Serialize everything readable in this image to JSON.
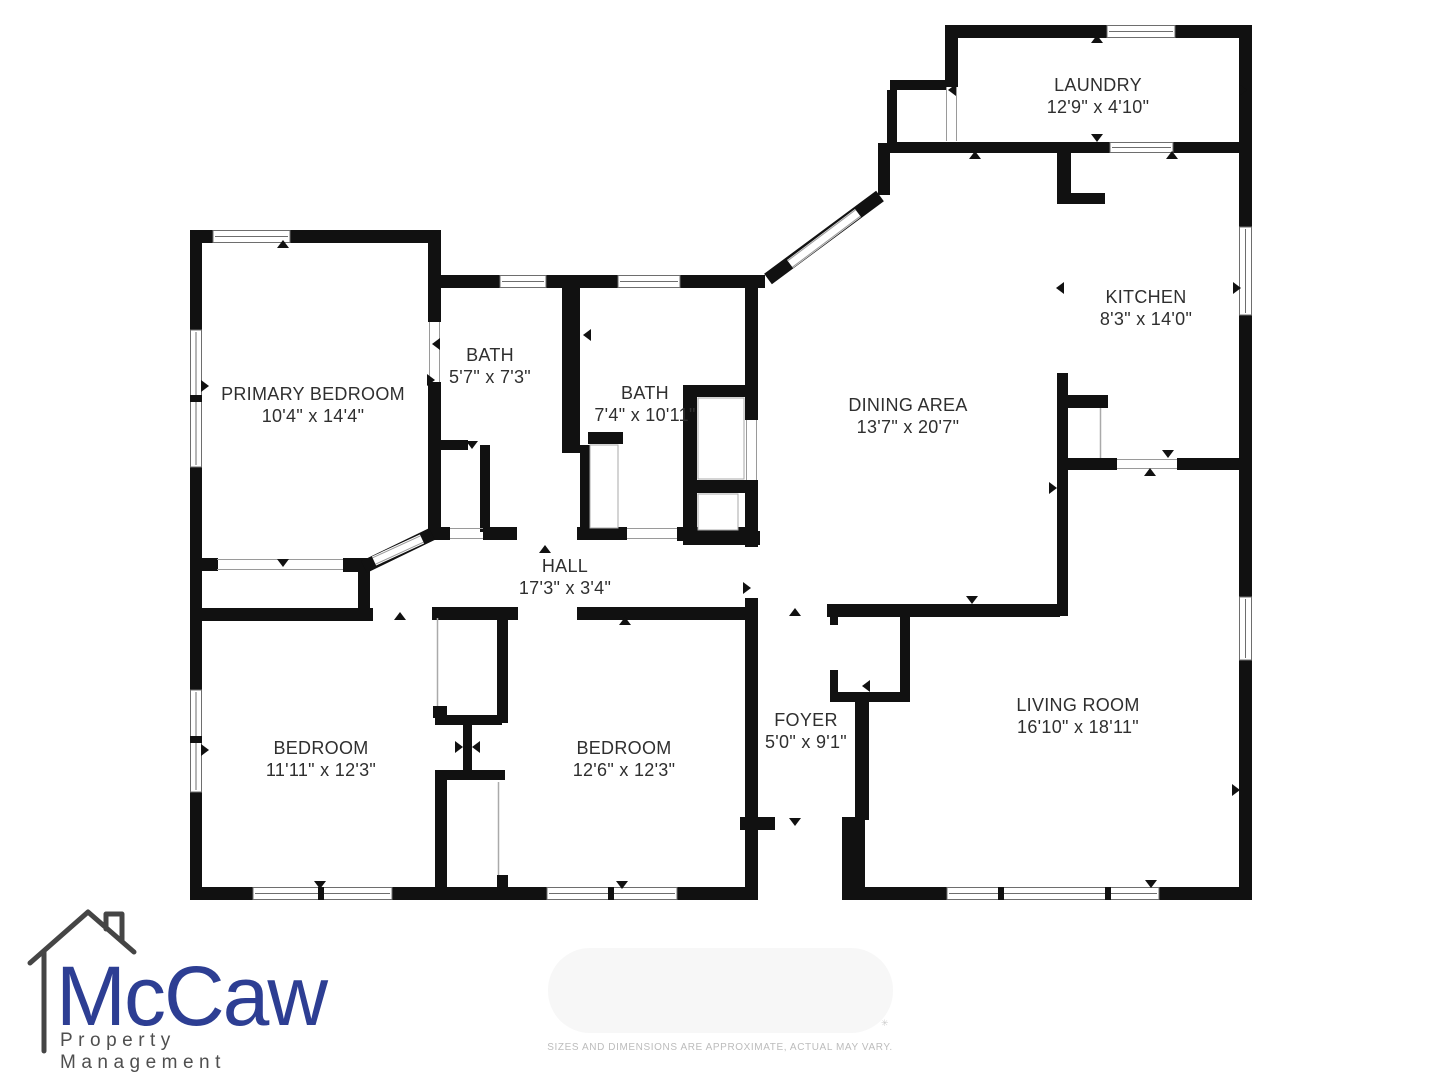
{
  "branding": {
    "name": "McCaw",
    "tagline": "Property Management",
    "brand_blue": "#2d3e93",
    "brand_gray": "#454545"
  },
  "disclaimer": "SIZES AND DIMENSIONS ARE APPROXIMATE, ACTUAL MAY VARY.",
  "colors": {
    "wall": "#111111",
    "label": "#2f2f2f"
  },
  "floor_plan": {
    "rooms": [
      {
        "id": "laundry",
        "name": "LAUNDRY",
        "dims": "12'9\" x 4'10\"",
        "cx": 1098,
        "cy": 96
      },
      {
        "id": "kitchen",
        "name": "KITCHEN",
        "dims": "8'3\" x 14'0\"",
        "cx": 1146,
        "cy": 308
      },
      {
        "id": "primary-bedroom",
        "name": "PRIMARY BEDROOM",
        "dims": "10'4\" x 14'4\"",
        "cx": 313,
        "cy": 405
      },
      {
        "id": "bath-1",
        "name": "BATH",
        "dims": "5'7\" x 7'3\"",
        "cx": 490,
        "cy": 366
      },
      {
        "id": "bath-2",
        "name": "BATH",
        "dims": "7'4\" x 10'11\"",
        "cx": 645,
        "cy": 404
      },
      {
        "id": "dining-area",
        "name": "DINING AREA",
        "dims": "13'7\" x 20'7\"",
        "cx": 908,
        "cy": 416
      },
      {
        "id": "hall",
        "name": "HALL",
        "dims": "17'3\" x 3'4\"",
        "cx": 565,
        "cy": 577
      },
      {
        "id": "bedroom-1",
        "name": "BEDROOM",
        "dims": "11'11\" x 12'3\"",
        "cx": 321,
        "cy": 759
      },
      {
        "id": "bedroom-2",
        "name": "BEDROOM",
        "dims": "12'6\" x 12'3\"",
        "cx": 624,
        "cy": 759
      },
      {
        "id": "foyer",
        "name": "FOYER",
        "dims": "5'0\" x 9'1\"",
        "cx": 806,
        "cy": 731
      },
      {
        "id": "living-room",
        "name": "LIVING ROOM",
        "dims": "16'10\" x 18'11\"",
        "cx": 1078,
        "cy": 716
      }
    ]
  }
}
